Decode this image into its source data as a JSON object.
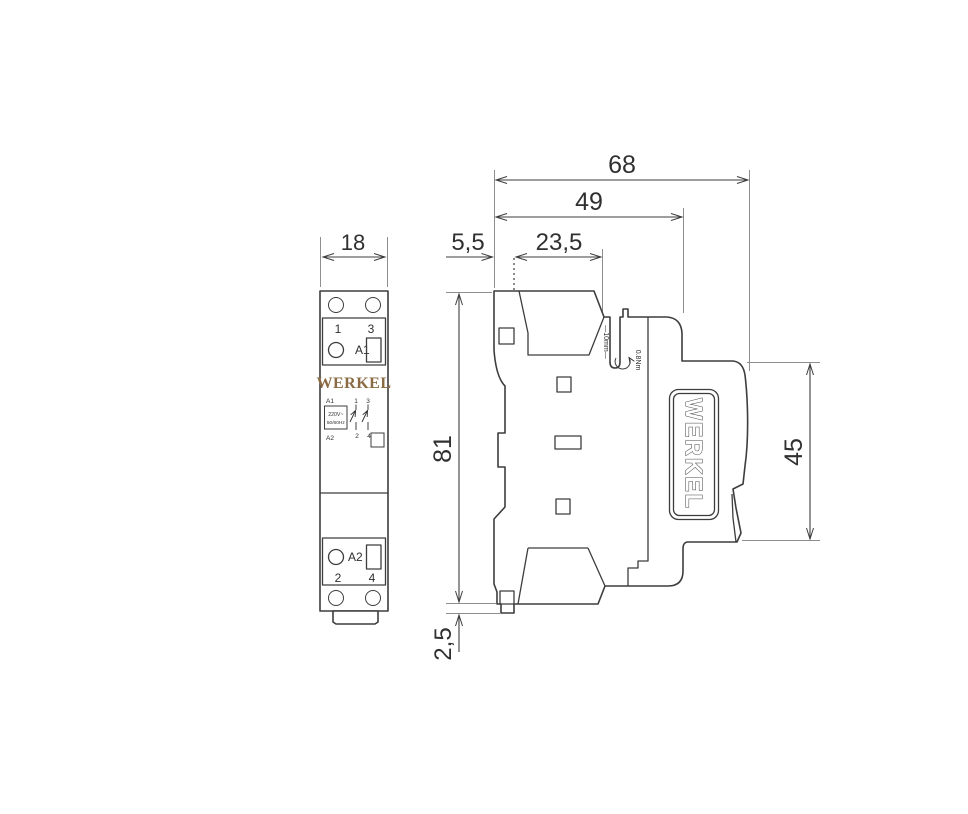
{
  "colors": {
    "gold": "#8a6b44",
    "line": "#3d3d3d",
    "ext": "#8e8e8e"
  },
  "brand": {
    "name": "WERKEL"
  },
  "front": {
    "dim_width": "18",
    "top_terminals": {
      "t1": "1",
      "t3": "3"
    },
    "coil_top": "A1",
    "coil_bottom": "A2",
    "bottom_terminals": {
      "t2": "2",
      "t4": "4"
    },
    "schematic": {
      "a1": "A1",
      "a2": "A2",
      "volt": "220V~",
      "freq": "50/60Hz",
      "p1": "1",
      "p3": "3",
      "p2": "2",
      "p4": "4"
    }
  },
  "side": {
    "dim_total_depth": "68",
    "dim_body_depth": "49",
    "dim_front_offset": "5,5",
    "dim_front_depth": "23,5",
    "dim_height": "81",
    "dim_rail_height": "45",
    "dim_clip": "2,5",
    "strip_length": "—10mm—",
    "torque": "0.8Nm"
  }
}
